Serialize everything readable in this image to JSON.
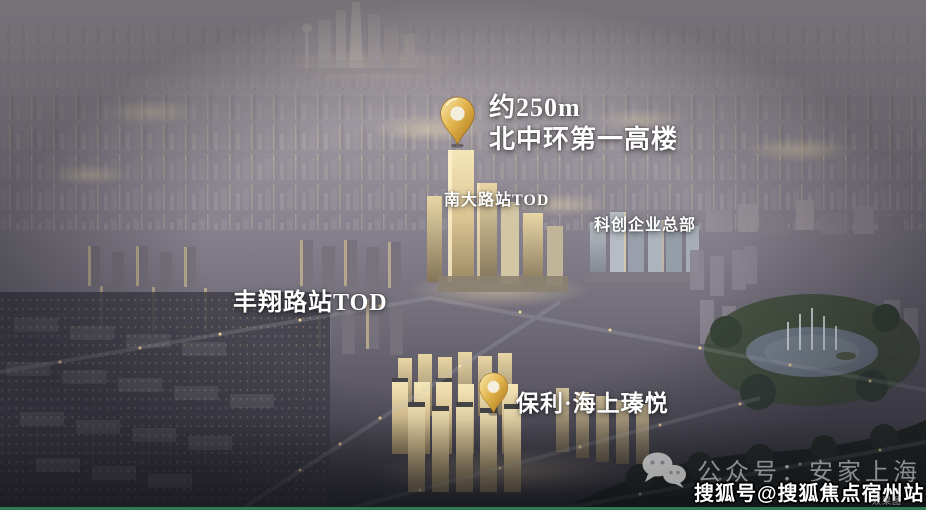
{
  "annotations": {
    "tower_height": {
      "line1": "约250m",
      "line2": "北中环第一高楼"
    },
    "stations": {
      "nanda_road_tod": "南大路站TOD",
      "tech_hq": "科创企业总部",
      "fengxiang_road_tod": "丰翔路站TOD"
    },
    "project_name": "保利·海上瑧悦",
    "wechat_account": "公众号：安家上海",
    "sohu_account": "搜狐号@搜狐焦点宿州站",
    "disclaimer": "效果图"
  },
  "icons": {
    "map_pin": "gold-map-pin-icon",
    "wechat": "wechat-icon"
  },
  "colors": {
    "pin_gold": "#e2b44e",
    "label_white": "#ffffff",
    "watermark_gray": "#cdcdcd",
    "bottom_line_green": "#2f7a50"
  }
}
